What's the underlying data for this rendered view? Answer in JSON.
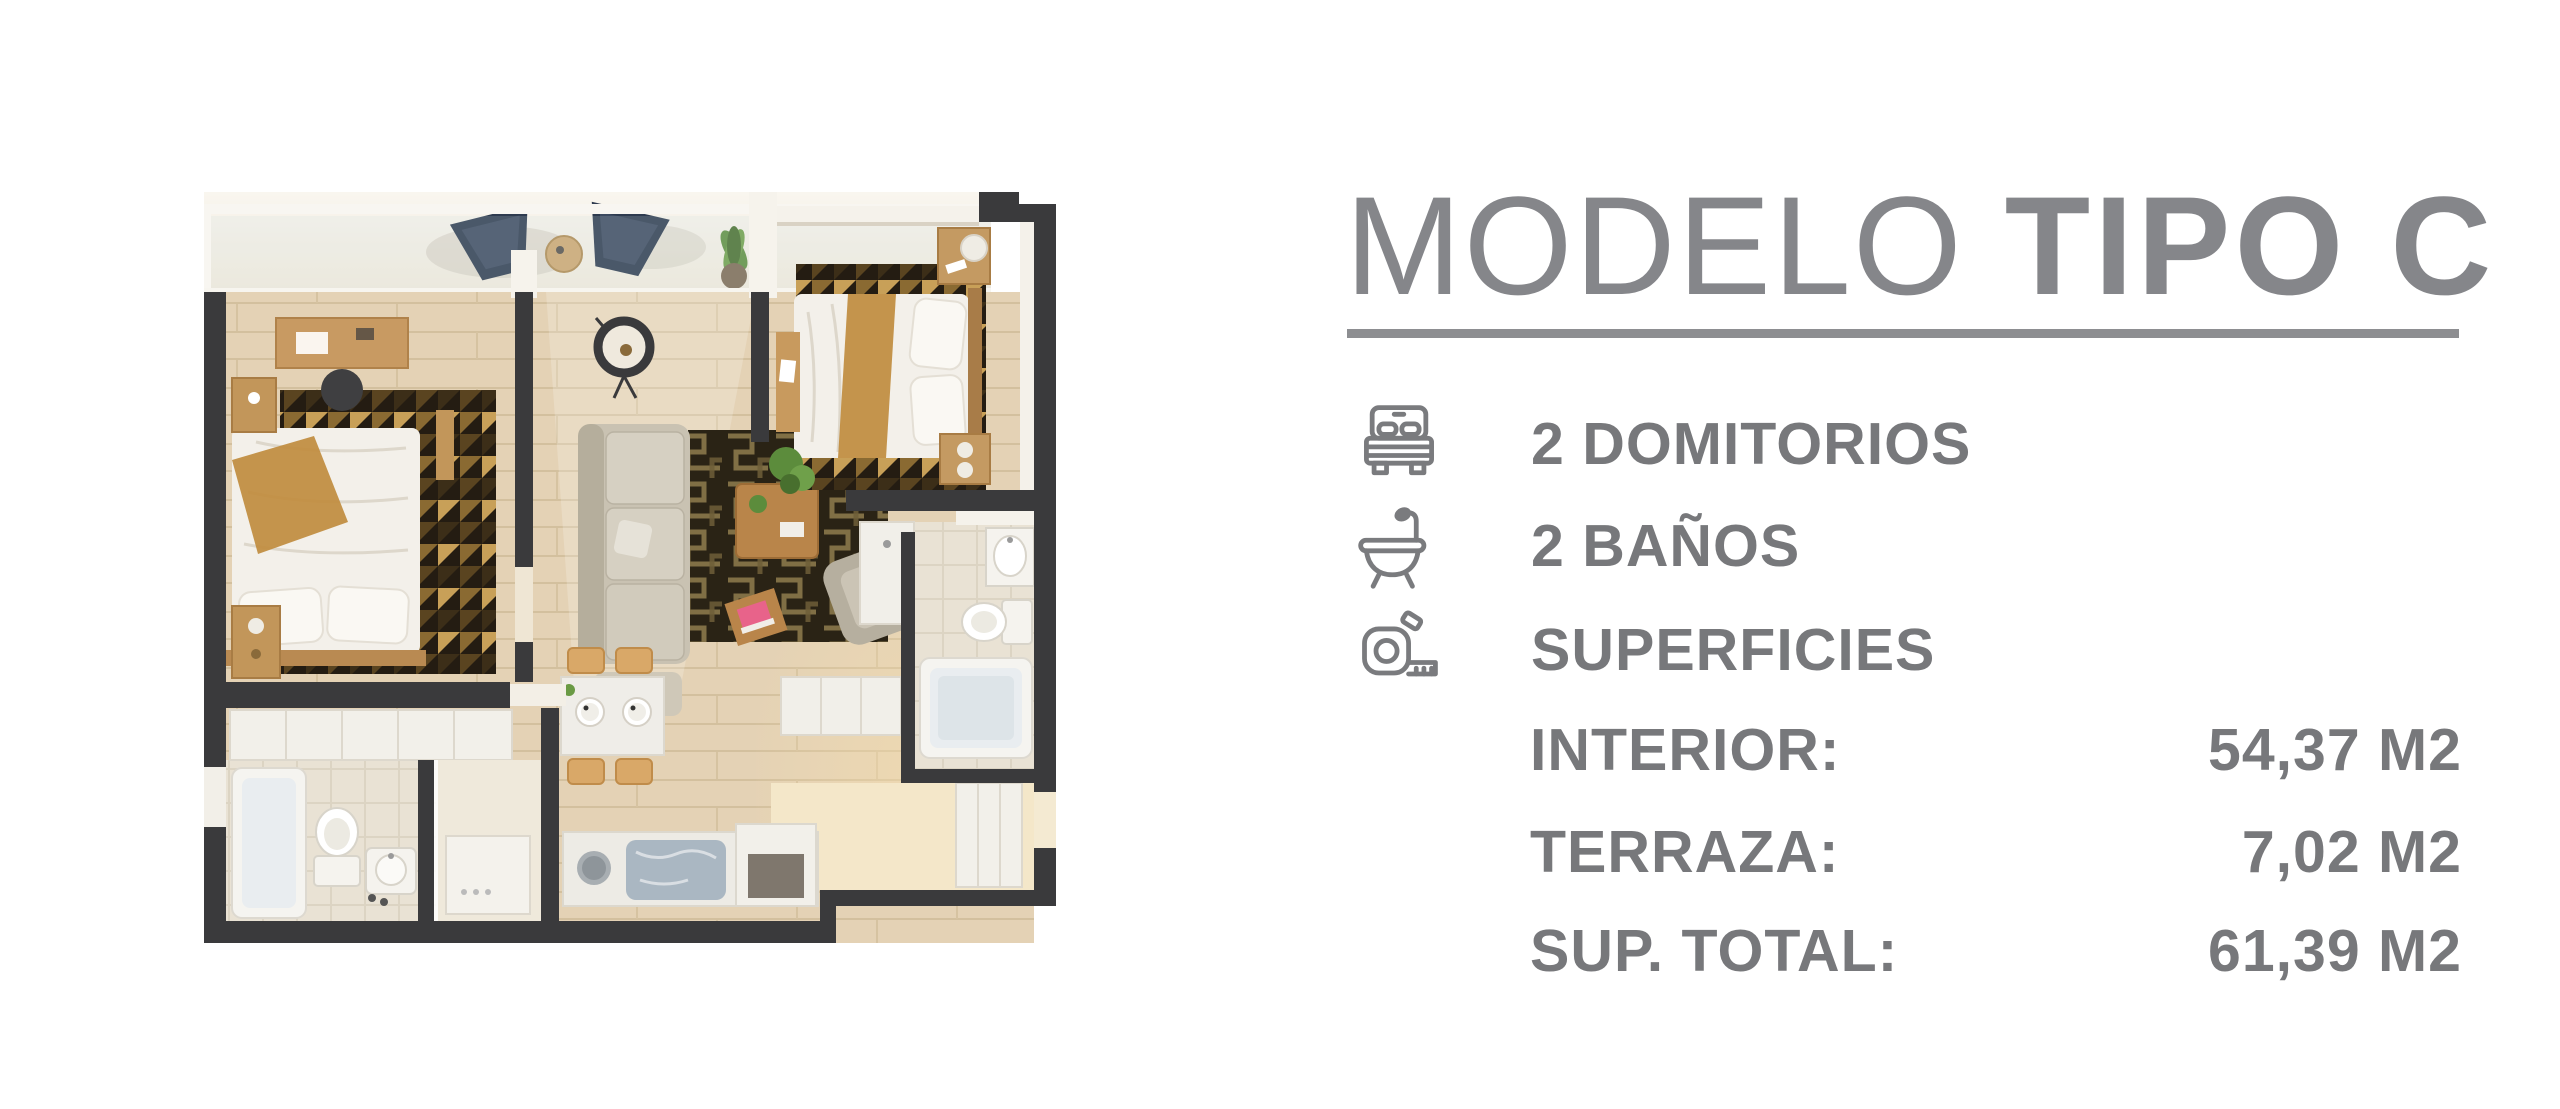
{
  "panel": {
    "title": {
      "light": "MODELO",
      "bold": "TIPO C"
    },
    "title_color": "#85868a",
    "divider_color": "#8d8e91",
    "text_color": "#77787b",
    "features": [
      {
        "icon": "bed-icon",
        "label": "2 DOMITORIOS"
      },
      {
        "icon": "bathtub-icon",
        "label": "2 BAÑOS"
      },
      {
        "icon": "measuring-tape-icon",
        "label": "SUPERFICIES"
      }
    ],
    "surfaces": [
      {
        "label": "INTERIOR:",
        "value": "54,37 M2"
      },
      {
        "label": "TERRAZA:",
        "value": "7,02 M2"
      },
      {
        "label": "SUP. TOTAL:",
        "value": "61,39 M2"
      }
    ]
  },
  "floorplan": {
    "colors": {
      "walls": "#3a3a3c",
      "wood_floor": "#e3d1b4",
      "tile_floor": "#e9e2d4",
      "terrace_floor": "#f2ebdc",
      "accent_wood": "#c49a62",
      "rug_dark": "#241c12",
      "rug_gold": "#c8a058",
      "sofa": "#c9c2b2",
      "bed_linen": "#f3f0ea",
      "throw_blanket": "#c08c3e",
      "plant_green": "#5c8c3c",
      "terrace_chair": "#2e3b4f",
      "sunlight": "#f7dfae"
    }
  }
}
